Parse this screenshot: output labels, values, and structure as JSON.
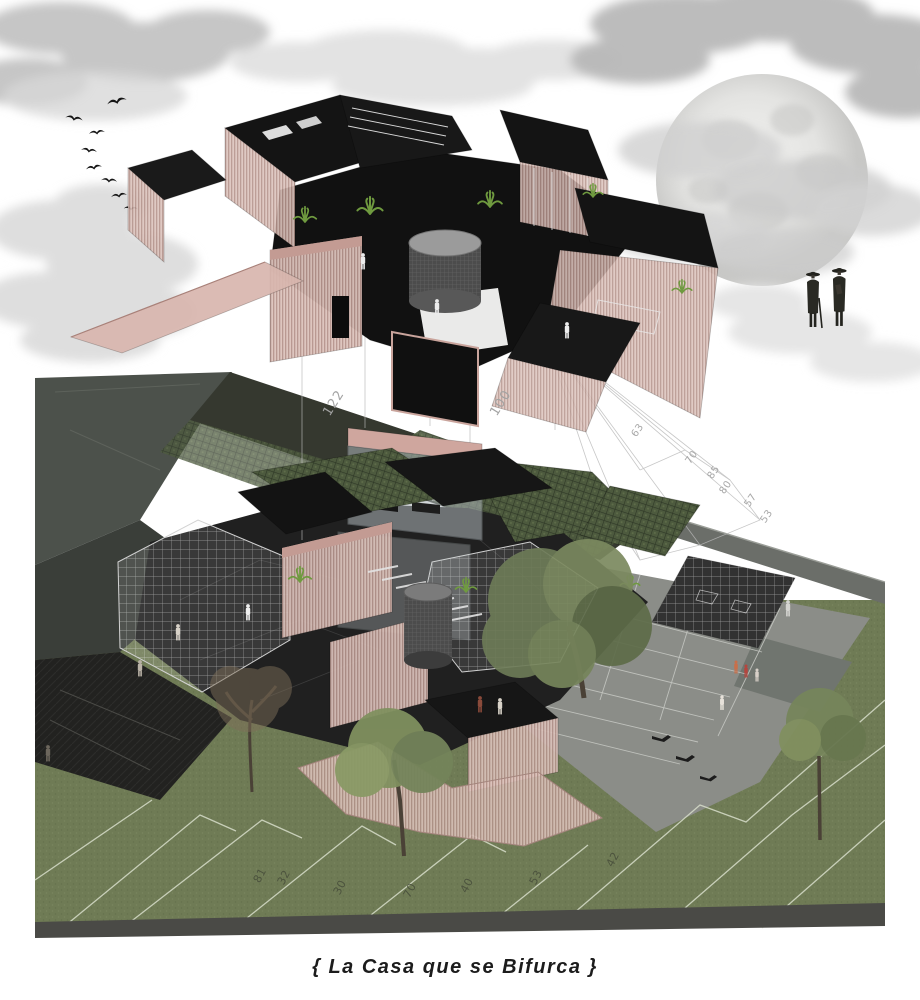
{
  "artwork": {
    "caption": "{ La Casa que se Bifurca }"
  },
  "annotations": {
    "dimension_labels": [
      "122",
      "100"
    ],
    "slope_labels": [
      "63",
      "70",
      "85",
      "80",
      "57",
      "53"
    ],
    "lawn_contour_labels": [
      "81",
      "32",
      "30",
      "70",
      "40",
      "53",
      "42"
    ]
  },
  "palette": {
    "mesh_pink": "#c9a49c",
    "mesh_pink_light": "#dcc3bc",
    "volume_black": "#141414",
    "lawn_green": "#6f7b55",
    "roof_grid_green": "#4d5a3e",
    "plaza_gray": "#8b8d88",
    "wall_gray_green": "#4c514b",
    "cloud_gray": "#c6c6c6",
    "moon_gray": "#dedede",
    "tree_green": "#71805a",
    "annotation_gray": "#a3a3a3"
  }
}
